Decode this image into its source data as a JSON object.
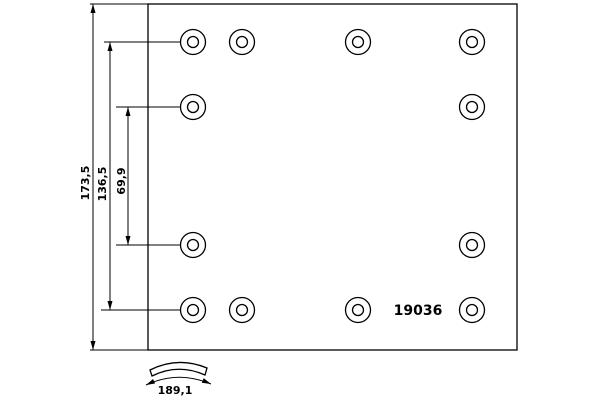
{
  "colors": {
    "line": "#000000",
    "background": "#ffffff"
  },
  "part": {
    "number": "19036"
  },
  "dimensions": {
    "total_height": "173,5",
    "hole_span_height": "136,5",
    "middle_hole_span": "69,9",
    "arc_length": "189,1"
  },
  "holes": {
    "outer_radius": 12.5,
    "inner_radius": 5.5,
    "positions": [
      {
        "x": 193,
        "y": 42
      },
      {
        "x": 242,
        "y": 42
      },
      {
        "x": 358,
        "y": 42
      },
      {
        "x": 472,
        "y": 42
      },
      {
        "x": 193,
        "y": 107
      },
      {
        "x": 472,
        "y": 107
      },
      {
        "x": 193,
        "y": 245
      },
      {
        "x": 472,
        "y": 245
      },
      {
        "x": 193,
        "y": 310
      },
      {
        "x": 242,
        "y": 310
      },
      {
        "x": 358,
        "y": 310
      },
      {
        "x": 472,
        "y": 310
      }
    ]
  }
}
